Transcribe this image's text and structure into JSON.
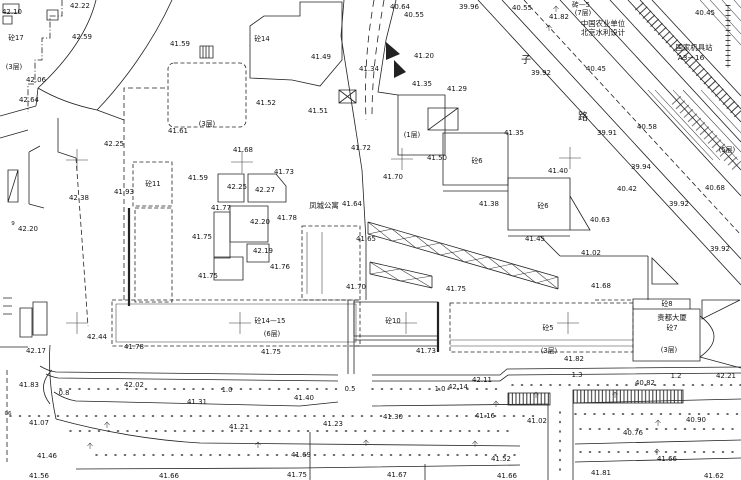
{
  "canvas": {
    "width": 741,
    "height": 480,
    "background": "#ffffff",
    "ink": "#222222",
    "drawing_type": "topographic-survey-site-plan"
  },
  "map": {
    "labels": [
      {
        "t": "42.10",
        "x": 12,
        "y": 14
      },
      {
        "t": "砼17",
        "x": 16,
        "y": 40,
        "k": "story"
      },
      {
        "t": "42.22",
        "x": 80,
        "y": 8
      },
      {
        "t": "42.59",
        "x": 82,
        "y": 39
      },
      {
        "t": "42.06",
        "x": 36,
        "y": 82
      },
      {
        "t": "42.64",
        "x": 29,
        "y": 102
      },
      {
        "t": "(3层)",
        "x": 14,
        "y": 69,
        "k": "story"
      },
      {
        "t": "41.59",
        "x": 180,
        "y": 46
      },
      {
        "t": "(3层)",
        "x": 207,
        "y": 126,
        "k": "story"
      },
      {
        "t": "41.61",
        "x": 178,
        "y": 133
      },
      {
        "t": "42.25",
        "x": 114,
        "y": 146
      },
      {
        "t": "砼14",
        "x": 262,
        "y": 41,
        "k": "story"
      },
      {
        "t": "41.49",
        "x": 321,
        "y": 59
      },
      {
        "t": "41.52",
        "x": 266,
        "y": 105
      },
      {
        "t": "41.51",
        "x": 318,
        "y": 113
      },
      {
        "t": "40.64",
        "x": 400,
        "y": 9
      },
      {
        "t": "40.55",
        "x": 414,
        "y": 17
      },
      {
        "t": "39.96",
        "x": 469,
        "y": 9
      },
      {
        "t": "40.55",
        "x": 522,
        "y": 10
      },
      {
        "t": "41.82",
        "x": 559,
        "y": 19
      },
      {
        "t": "砖—5",
        "x": 581,
        "y": 7,
        "k": "story"
      },
      {
        "t": "(7层)",
        "x": 583,
        "y": 15,
        "k": "story"
      },
      {
        "t": "中国农业单位",
        "x": 603,
        "y": 26,
        "k": "name"
      },
      {
        "t": "北京水利设计",
        "x": 603,
        "y": 35,
        "k": "name"
      },
      {
        "t": "国家机具站",
        "x": 694,
        "y": 50,
        "k": "name"
      },
      {
        "t": "A3—16",
        "x": 691,
        "y": 60,
        "k": "name"
      },
      {
        "t": "40.45",
        "x": 705,
        "y": 15
      },
      {
        "t": "41.34",
        "x": 369,
        "y": 71
      },
      {
        "t": "41.20",
        "x": 424,
        "y": 58
      },
      {
        "t": "41.35",
        "x": 422,
        "y": 86
      },
      {
        "t": "41.29",
        "x": 457,
        "y": 91
      },
      {
        "t": "子",
        "x": 526,
        "y": 63,
        "k": "char"
      },
      {
        "t": "39.92",
        "x": 541,
        "y": 75
      },
      {
        "t": "40.45",
        "x": 596,
        "y": 71
      },
      {
        "t": "路",
        "x": 583,
        "y": 120,
        "k": "char"
      },
      {
        "t": "39.91",
        "x": 607,
        "y": 135
      },
      {
        "t": "40.58",
        "x": 647,
        "y": 129
      },
      {
        "t": "(5层)",
        "x": 727,
        "y": 152,
        "k": "story"
      },
      {
        "t": "41.72",
        "x": 361,
        "y": 150
      },
      {
        "t": "41.50",
        "x": 437,
        "y": 160
      },
      {
        "t": "41.35",
        "x": 514,
        "y": 135
      },
      {
        "t": "砼6",
        "x": 477,
        "y": 163,
        "k": "story"
      },
      {
        "t": "(1层)",
        "x": 412,
        "y": 137,
        "k": "story"
      },
      {
        "t": "41.70",
        "x": 393,
        "y": 179
      },
      {
        "t": "41.40",
        "x": 558,
        "y": 173
      },
      {
        "t": "41.38",
        "x": 489,
        "y": 206
      },
      {
        "t": "砼6",
        "x": 543,
        "y": 208,
        "k": "story"
      },
      {
        "t": "40.63",
        "x": 600,
        "y": 222
      },
      {
        "t": "41.45",
        "x": 535,
        "y": 241
      },
      {
        "t": "40.42",
        "x": 627,
        "y": 191
      },
      {
        "t": "39.94",
        "x": 641,
        "y": 169
      },
      {
        "t": "39.92",
        "x": 679,
        "y": 206
      },
      {
        "t": "40.68",
        "x": 715,
        "y": 190
      },
      {
        "t": "39.92",
        "x": 720,
        "y": 251
      },
      {
        "t": "41.02",
        "x": 591,
        "y": 255
      },
      {
        "t": "41.68",
        "x": 601,
        "y": 288
      },
      {
        "t": "41.68",
        "x": 243,
        "y": 152
      },
      {
        "t": "41.73",
        "x": 284,
        "y": 174
      },
      {
        "t": "41.59",
        "x": 198,
        "y": 180
      },
      {
        "t": "42.25",
        "x": 237,
        "y": 189
      },
      {
        "t": "42.27",
        "x": 265,
        "y": 192
      },
      {
        "t": "41.77",
        "x": 221,
        "y": 210
      },
      {
        "t": "42.20",
        "x": 260,
        "y": 224
      },
      {
        "t": "41.78",
        "x": 287,
        "y": 220
      },
      {
        "t": "41.75",
        "x": 202,
        "y": 239
      },
      {
        "t": "42.19",
        "x": 263,
        "y": 253
      },
      {
        "t": "41.76",
        "x": 280,
        "y": 269
      },
      {
        "t": "41.75",
        "x": 208,
        "y": 278
      },
      {
        "t": "凤城公寓",
        "x": 324,
        "y": 208,
        "k": "name"
      },
      {
        "t": "41.64",
        "x": 352,
        "y": 206
      },
      {
        "t": "41.65",
        "x": 366,
        "y": 241
      },
      {
        "t": "41.70",
        "x": 356,
        "y": 289
      },
      {
        "t": "41.75",
        "x": 456,
        "y": 291
      },
      {
        "t": "41.93",
        "x": 124,
        "y": 194
      },
      {
        "t": "42.38",
        "x": 79,
        "y": 200
      },
      {
        "t": "砼11",
        "x": 153,
        "y": 186,
        "k": "story"
      },
      {
        "t": "42.20",
        "x": 28,
        "y": 231
      },
      {
        "t": "9",
        "x": 13,
        "y": 225,
        "k": "sm"
      },
      {
        "t": "42.44",
        "x": 97,
        "y": 339
      },
      {
        "t": "42.17",
        "x": 36,
        "y": 353
      },
      {
        "t": "41.78",
        "x": 134,
        "y": 349
      },
      {
        "t": "砼14—15",
        "x": 270,
        "y": 323,
        "k": "story"
      },
      {
        "t": "(6层)",
        "x": 272,
        "y": 336,
        "k": "story"
      },
      {
        "t": "41.75",
        "x": 271,
        "y": 354
      },
      {
        "t": "砼10",
        "x": 393,
        "y": 323,
        "k": "story"
      },
      {
        "t": "41.73",
        "x": 426,
        "y": 353
      },
      {
        "t": "砼5",
        "x": 548,
        "y": 330,
        "k": "story"
      },
      {
        "t": "(3层)",
        "x": 549,
        "y": 353,
        "k": "story"
      },
      {
        "t": "41.82",
        "x": 574,
        "y": 361
      },
      {
        "t": "砼8",
        "x": 667,
        "y": 306,
        "k": "story"
      },
      {
        "t": "贵都大厦",
        "x": 672,
        "y": 320,
        "k": "name"
      },
      {
        "t": "砼7",
        "x": 672,
        "y": 330,
        "k": "story"
      },
      {
        "t": "(3层)",
        "x": 669,
        "y": 352,
        "k": "story"
      },
      {
        "t": "41.83",
        "x": 29,
        "y": 387
      },
      {
        "t": "42.02",
        "x": 134,
        "y": 387
      },
      {
        "t": "0.8",
        "x": 64,
        "y": 395,
        "k": "dim"
      },
      {
        "t": "1.0",
        "x": 227,
        "y": 392,
        "k": "dim"
      },
      {
        "t": "41.31",
        "x": 197,
        "y": 404
      },
      {
        "t": "41.40",
        "x": 304,
        "y": 400
      },
      {
        "t": "0.5",
        "x": 350,
        "y": 391,
        "k": "dim"
      },
      {
        "t": "1.0",
        "x": 440,
        "y": 391,
        "k": "dim"
      },
      {
        "t": "42.14",
        "x": 458,
        "y": 389
      },
      {
        "t": "42.11",
        "x": 482,
        "y": 382
      },
      {
        "t": "1.3",
        "x": 577,
        "y": 377,
        "k": "dim"
      },
      {
        "t": "1.2",
        "x": 676,
        "y": 378,
        "k": "dim"
      },
      {
        "t": "42.21",
        "x": 726,
        "y": 378
      },
      {
        "t": "40.82",
        "x": 645,
        "y": 385
      },
      {
        "t": "41.07",
        "x": 39,
        "y": 425
      },
      {
        "t": "41.21",
        "x": 239,
        "y": 429
      },
      {
        "t": "41.23",
        "x": 333,
        "y": 426
      },
      {
        "t": "41.30",
        "x": 393,
        "y": 419
      },
      {
        "t": "41.16",
        "x": 485,
        "y": 418
      },
      {
        "t": "41.02",
        "x": 537,
        "y": 423
      },
      {
        "t": "40.76",
        "x": 633,
        "y": 435
      },
      {
        "t": "40.90",
        "x": 696,
        "y": 422
      },
      {
        "t": "06",
        "x": 8,
        "y": 415,
        "k": "sm"
      },
      {
        "t": "41.46",
        "x": 47,
        "y": 458
      },
      {
        "t": "41.69",
        "x": 301,
        "y": 457
      },
      {
        "t": "41.52",
        "x": 501,
        "y": 461
      },
      {
        "t": "41.66",
        "x": 667,
        "y": 461
      },
      {
        "t": "41.56",
        "x": 39,
        "y": 478
      },
      {
        "t": "41.66",
        "x": 169,
        "y": 478
      },
      {
        "t": "41.75",
        "x": 297,
        "y": 477
      },
      {
        "t": "41.67",
        "x": 397,
        "y": 477
      },
      {
        "t": "41.66",
        "x": 507,
        "y": 478
      },
      {
        "t": "41.81",
        "x": 601,
        "y": 475
      },
      {
        "t": "41.62",
        "x": 714,
        "y": 478
      }
    ],
    "survey_crosses": [
      [
        77,
        160
      ],
      [
        242,
        162
      ],
      [
        402,
        159
      ],
      [
        570,
        158
      ],
      [
        77,
        323
      ],
      [
        240,
        323
      ],
      [
        406,
        323
      ],
      [
        568,
        323
      ]
    ],
    "trees": [
      [
        556,
        8
      ],
      [
        549,
        27
      ],
      [
        107,
        424
      ],
      [
        90,
        445
      ],
      [
        258,
        444
      ],
      [
        366,
        442
      ],
      [
        475,
        443
      ],
      [
        536,
        394
      ],
      [
        615,
        394
      ],
      [
        657,
        451
      ],
      [
        658,
        422
      ],
      [
        496,
        403
      ]
    ]
  }
}
